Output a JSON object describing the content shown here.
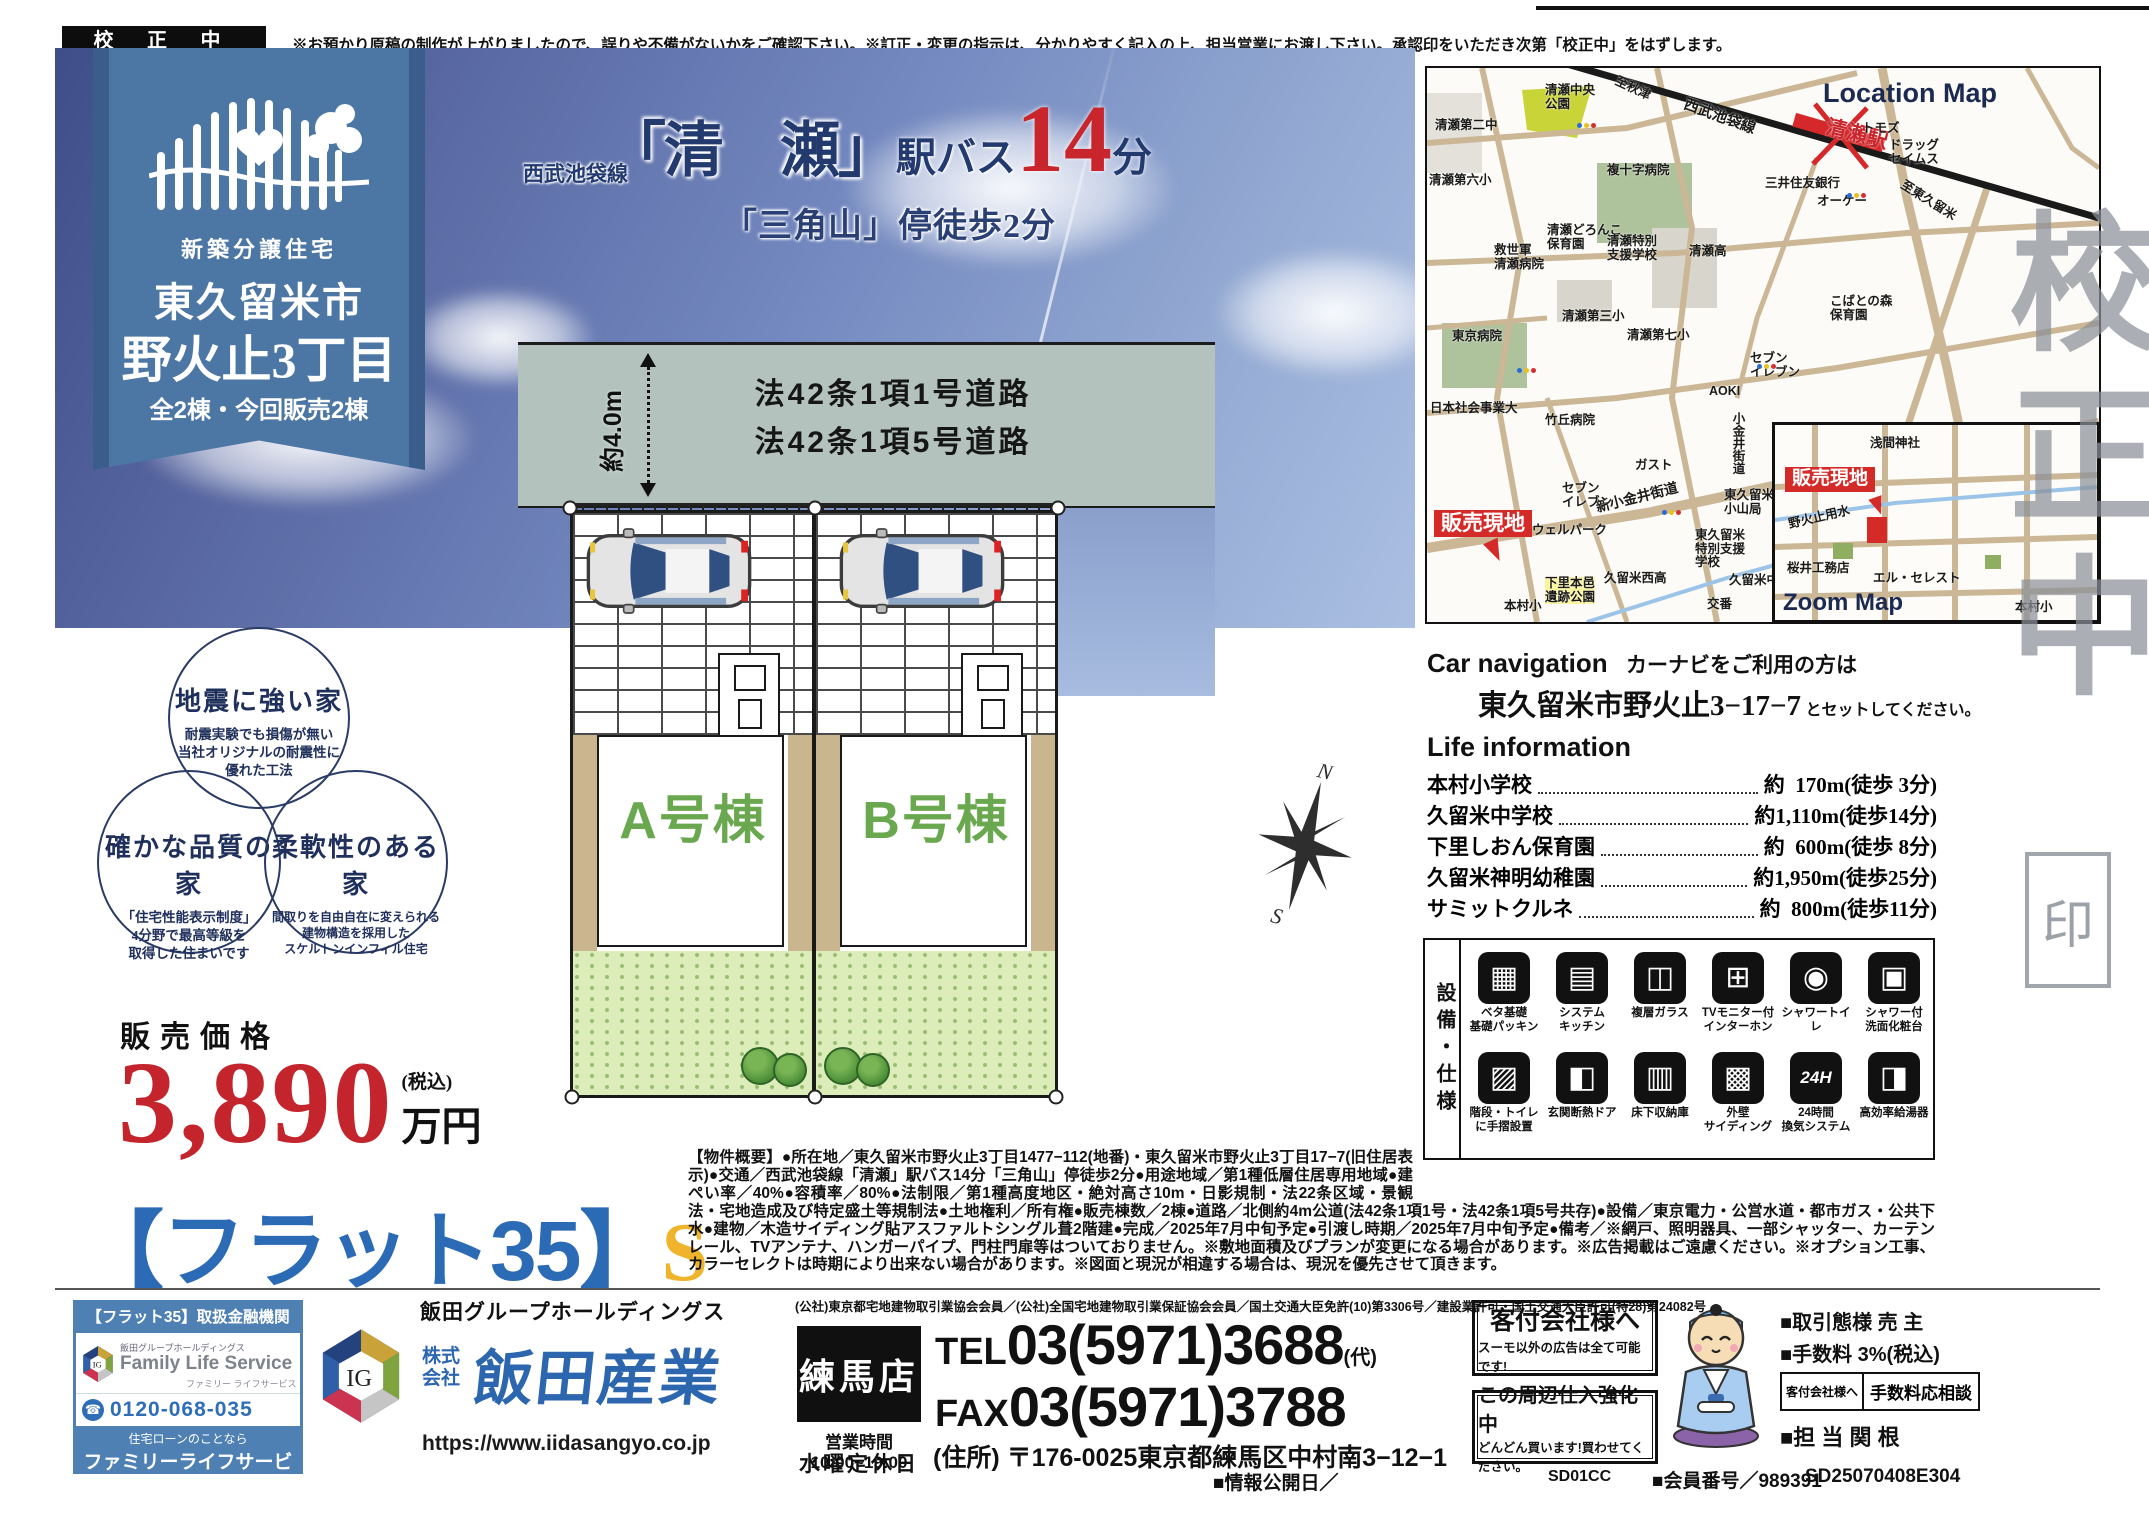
{
  "proof": {
    "badge": "校 正 中",
    "notice": "※お預かり原稿の制作が上がりましたので、誤りや不備がないかをご確認下さい。※訂正・変更の指示は、分かりやすく記入の上、担当営業にお渡し下さい。承認印をいただき次第「校正中」をはずします。",
    "watermark": "校正中",
    "seal": "印"
  },
  "ribbon": {
    "tagline": "新築分譲住宅",
    "city": "東久留米市",
    "town": "野火止3丁目",
    "units": "全2棟・今回販売2棟"
  },
  "headline": {
    "railway": "西武池袋線",
    "station": "「清　瀬」",
    "suffix": "駅バス",
    "minutes": "14",
    "unit": "分",
    "line2": "「三角山」停徒歩2分"
  },
  "siteplan": {
    "road_width": "約4.0m",
    "road_law1": "法42条1項1号道路",
    "road_law2": "法42条1項5号道路",
    "lot_a": "A号棟",
    "lot_b": "B号棟",
    "north": "N",
    "south": "S"
  },
  "features": [
    {
      "title": "地震に強い家",
      "desc": "耐震実験でも損傷が無い\n当社オリジナルの耐震性に\n優れた工法"
    },
    {
      "title": "確かな品質の家",
      "desc": "「住宅性能表示制度」\n4分野で最高等級を\n取得した住まいです"
    },
    {
      "title": "柔軟性のある家",
      "desc": "間取りを自由自在に変えられる\n建物構造を採用した\nスケルトンインフィル住宅"
    }
  ],
  "price": {
    "label": "販売価格",
    "amount": "3,890",
    "tax": "(税込)",
    "unit": "万円"
  },
  "flat35": {
    "name": "【フラット35】",
    "s": "S"
  },
  "overview": "【物件概要】●所在地／東久留米市野火止3丁目1477−112(地番)・東久留米市野火止3丁目17−7(旧住居表示)●交通／西武池袋線「清瀬」駅バス14分「三角山」停徒歩2分●用途地域／第1種低層住居専用地域●建ぺい率／40%●容積率／80%●法制限／第1種高度地区・絶対高さ10m・日影規制・法22条区域・景観法・宅地造成及び特定盛土等規制法●土地権利／所有権●販売棟数／2棟●道路／北側約4m公道(法42条1項1号・法42条1項5号共存)●設備／東京電力・公営水道・都市ガス・公共下水●建物／木造サイディング貼アスファルトシングル葺2階建●完成／2025年7月中旬予定●引渡し時期／2025年7月中旬予定●備考／※網戸、照明器具、一部シャッター、カーテンレール、TVアンテナ、ハンガーパイプ、門柱門扉等はついておりません。※敷地面積及びプランが変更になる場合があります。※広告掲載はご遠慮ください。※オプション工事、カラーセレクトは時期により出来ない場合があります。※図面と現況が相違する場合は、現況を優先させて頂きます。",
  "carnav": {
    "title": "Car navigation",
    "sub": "カーナビをご利用の方は",
    "address": "東久留米市野火止3−17−7",
    "suffix": "とセットしてください。"
  },
  "life": {
    "title": "Life information",
    "items": [
      {
        "name": "本村小学校",
        "dist": "約  170m(徒歩 3分)"
      },
      {
        "name": "久留米中学校",
        "dist": "約1,110m(徒歩14分)"
      },
      {
        "name": "下里しおん保育園",
        "dist": "約  600m(徒歩 8分)"
      },
      {
        "name": "久留米神明幼稚園",
        "dist": "約1,950m(徒歩25分)"
      },
      {
        "name": "サミットクルネ",
        "dist": "約  800m(徒歩11分)"
      }
    ]
  },
  "equipment": {
    "side": "設備・仕様",
    "items": [
      {
        "glyph": "▦",
        "label": "ベタ基礎\n基礎パッキン"
      },
      {
        "glyph": "▤",
        "label": "システム\nキッチン"
      },
      {
        "glyph": "◫",
        "label": "複層ガラス"
      },
      {
        "glyph": "⊞",
        "label": "TVモニター付\nインターホン"
      },
      {
        "glyph": "◉",
        "label": "シャワートイレ"
      },
      {
        "glyph": "▣",
        "label": "シャワー付\n洗面化粧台"
      },
      {
        "glyph": "▨",
        "label": "階段・トイレ\nに手摺設置"
      },
      {
        "glyph": "◧",
        "label": "玄関断熱ドア"
      },
      {
        "glyph": "▥",
        "label": "床下収納庫"
      },
      {
        "glyph": "▩",
        "label": "外壁\nサイディング"
      },
      {
        "glyph": "24H",
        "label": "24時間\n換気システム"
      },
      {
        "glyph": "◨",
        "label": "高効率給湯器"
      }
    ]
  },
  "maps": {
    "loc_title": "Location Map",
    "zoom_title": "Zoom Map",
    "flag": "販売現地",
    "loc_labels": [
      "清瀬中央\n公園",
      "至秋津",
      "西武池袋線",
      "清瀬駅",
      "トモズ",
      "ドラッグ\nセイムス",
      "三井住友銀行",
      "オーケー",
      "至東久留米",
      "清瀬第二中",
      "清瀬第六小",
      "複十字病院",
      "清瀬どろんこ\n保育園",
      "清瀬特別\n支援学校",
      "清瀬高",
      "救世軍\n清瀬病院",
      "東京病院",
      "清瀬第三小",
      "清瀬第七小",
      "こばとの森\n保育園",
      "日本社会事業大",
      "竹丘病院",
      "セブン\nイレブン",
      "AOKI",
      "小金井街道",
      "新小金井街道",
      "セブン\nイレブン",
      "ウェルパーク",
      "ガスト",
      "東久留米\n小山局",
      "東久留米\n特別支援\n学校",
      "下里本邑\n遺跡公園",
      "久留米西高",
      "本村小",
      "交番",
      "久留米中"
    ],
    "zoom_labels": [
      "浅間神社",
      "野火止用水",
      "桜井工務店",
      "エル・セレスト",
      "本村小"
    ]
  },
  "fls": {
    "header": "【フラット35】取扱金融機関",
    "group": "飯田グループホールディングス",
    "brand": "Family Life Service",
    "brand_sub": "ファミリー ライフサービス",
    "phone": "0120-068-035",
    "note": "住宅ローンのことなら",
    "name_jp": "ファミリーライフサービス"
  },
  "company": {
    "holdings": "飯田グループホールディングス",
    "prefix": "株式\n会社",
    "name": "飯田産業",
    "url": "https://www.iidasangyo.co.jp",
    "logo": "IG"
  },
  "store": {
    "name": "練馬店",
    "hours": "営業時間 10:00~19:00",
    "closed": "水曜定休日"
  },
  "contact": {
    "license": "(公社)東京都宅地建物取引業協会会員／(公社)全国宅地建物取引業保証協会会員／国土交通大臣免許(10)第3306号／建設業許可・国土交通大臣許可(特28)第24082号",
    "tel_label": "TEL",
    "tel": "03(5971)3688",
    "tel_note": "(代)",
    "fax_label": "FAX",
    "fax": "03(5971)3788",
    "address": "(住所) 〒176-0025東京都練馬区中村南3−12−1",
    "info_date": "■情報公開日／"
  },
  "agent": {
    "box1_title": "客付会社様へ",
    "box1_sub": "スーモ以外の広告は全て可能です!",
    "box2_title": "この周辺仕入強化中",
    "box2_sub": "どんどん買います!買わせてください。",
    "deal": "■取引態様 売 主",
    "fee": "■手数料 3%(税込)",
    "table_l": "客付会社様へ",
    "table_r": "手数料応相談",
    "staff": "■担 当 関 根",
    "code1": "SD01CC",
    "member": "■会員番号／989391",
    "code2": "SD25070408E304"
  }
}
